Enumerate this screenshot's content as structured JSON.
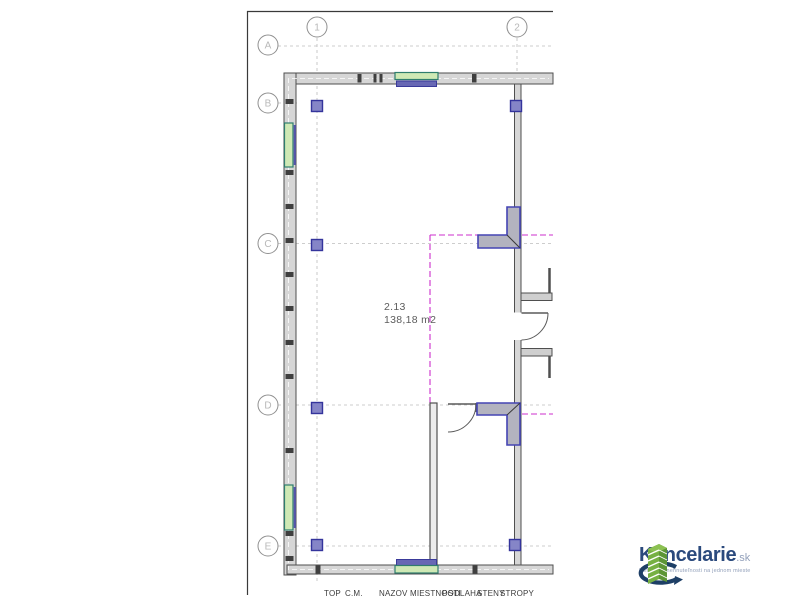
{
  "theme": {
    "boundary_magenta": "#cc2fcc",
    "window_green": "#cfe9b5",
    "window_frame_teal": "#2f7d6e",
    "sill_purple": "#6868b4",
    "column_purple": "#8585c7",
    "column_border": "#34349c",
    "wall_fill": "#d6d6d6",
    "wall_line": "#4f4f4f",
    "grid_gray": "#bdbdbd",
    "junction_border": "#4444b4",
    "logo_navy": "#2b4a7d",
    "logo_green": "#76b043",
    "logo_green_dark": "#5d9636",
    "logo_gray_blue": "#93a1bb"
  },
  "plan": {
    "room_label": {
      "number": "2.13",
      "area": "138,18 m2"
    },
    "grid_columns": [
      {
        "label": "1"
      },
      {
        "label": "2"
      }
    ],
    "grid_rows": [
      {
        "label": "A"
      },
      {
        "label": "B"
      },
      {
        "label": "C"
      },
      {
        "label": "D"
      },
      {
        "label": "E"
      }
    ],
    "legend": {
      "columns": [
        "TOP",
        "C.M.",
        "NAZOV MIESTNOSTI",
        "PODLAHA",
        "STENY",
        "STROPY"
      ]
    }
  },
  "logo": {
    "brand": "Kancelarie",
    "tld": ".sk",
    "tagline": "komerčné nehnuteľnosti na jednom mieste"
  }
}
